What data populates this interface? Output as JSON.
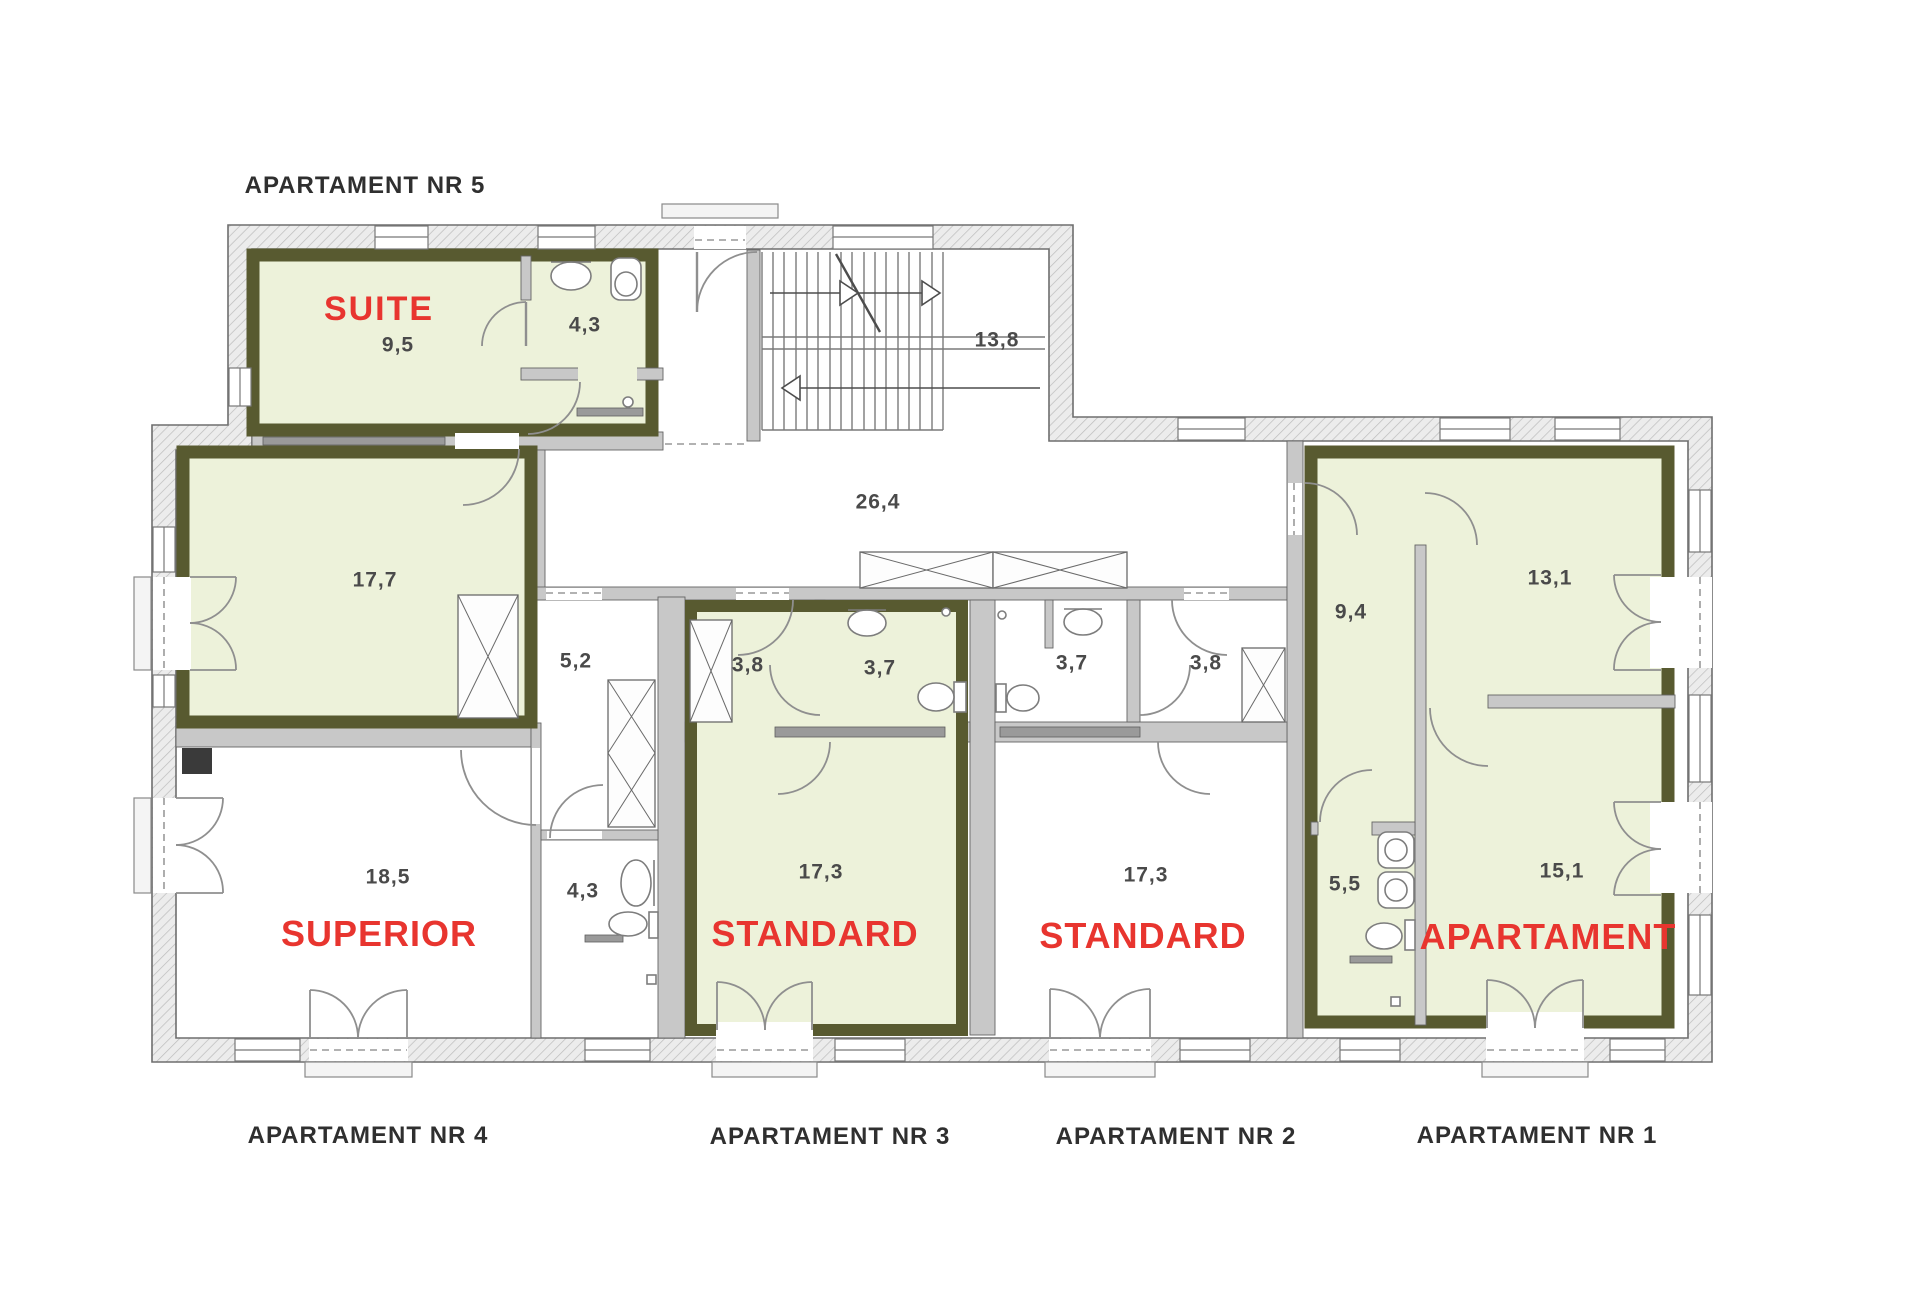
{
  "floor_plan": {
    "apartment_labels": {
      "nr5": "APARTAMENT NR 5",
      "nr4": "APARTAMENT NR 4",
      "nr3": "APARTAMENT NR 3",
      "nr2": "APARTAMENT NR 2",
      "nr1": "APARTAMENT NR 1"
    },
    "room_types": {
      "suite": "SUITE",
      "superior": "SUPERIOR",
      "standard_nr3": "STANDARD",
      "standard_nr2": "STANDARD",
      "apartament_nr1": "APARTAMENT"
    },
    "areas_m2": {
      "suite_bedroom": "9,5",
      "suite_bath": "4,3",
      "suite_living": "17,7",
      "hall_5_2": "5,2",
      "corridor": "26,4",
      "staircase": "13,8",
      "nr3_hall": "3,8",
      "nr3_bath": "3,7",
      "nr2_bath": "3,7",
      "nr2_hall": "3,8",
      "nr3_room": "17,3",
      "nr2_room": "17,3",
      "nr4_room": "18,5",
      "nr4_bath": "4,3",
      "nr1_hall": "9,4",
      "nr1_room_top": "13,1",
      "nr1_bath": "5,5",
      "nr1_room_bottom": "15,1"
    },
    "colors": {
      "highlight_fill": "#edf2da",
      "highlight_border": "#585a30",
      "label_red": "#e8352f",
      "wall_gray": "#c8c8c8",
      "line_dark": "#555555"
    }
  }
}
